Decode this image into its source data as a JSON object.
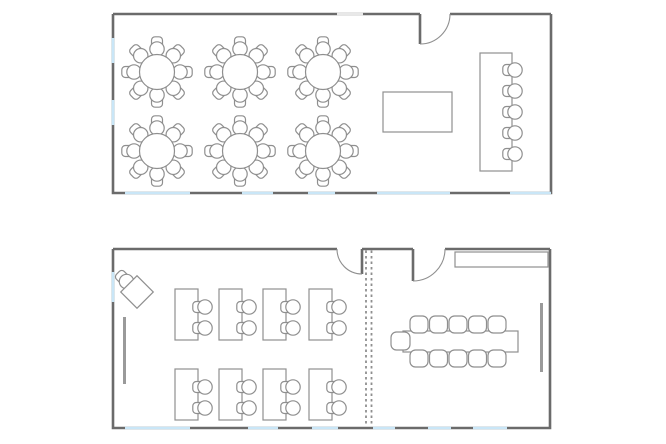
{
  "canvas": {
    "w": 666,
    "h": 444,
    "background": "#ffffff"
  },
  "style": {
    "wall_color": "#6b6b6b",
    "wall_width": 2.6,
    "window_color": "#c9e6f7",
    "opening_color": "#e8e8e8",
    "furn_color": "#8f8f8f",
    "furn_width": 1.2,
    "furn_fill": "#ffffff",
    "seat_r": 7.2,
    "back_size": 11,
    "board_color": "#9a9a9a",
    "board_width": 3,
    "partition_color": "#8f8f8f",
    "partition_width": 1.8,
    "partition_dash": "2.5 3"
  },
  "plans": [
    {
      "id": "top-plan",
      "name": "banquet-room",
      "room": {
        "x": 113,
        "y": 14,
        "w": 438,
        "h": 179
      },
      "top_wall_segments": [
        [
          113,
          420
        ],
        [
          450,
          551
        ]
      ],
      "openings": [
        {
          "side": "top",
          "from": 337,
          "to": 363
        }
      ],
      "doors": [
        {
          "leaf": [
            420,
            14,
            420,
            44
          ],
          "arc": "M 420 44 A 30 30 0 0 0 450 14"
        }
      ],
      "windows": [
        {
          "side": "left",
          "from": 38,
          "to": 63
        },
        {
          "side": "left",
          "from": 100,
          "to": 125
        },
        {
          "side": "bottom",
          "from": 125,
          "to": 190
        },
        {
          "side": "bottom",
          "from": 242,
          "to": 273
        },
        {
          "side": "bottom",
          "from": 308,
          "to": 335
        },
        {
          "side": "bottom",
          "from": 377,
          "to": 450
        },
        {
          "side": "bottom",
          "from": 510,
          "to": 551
        }
      ],
      "round_tables": {
        "radius": 17.5,
        "seat_ring": 23,
        "chairs_per": 8,
        "centers": [
          [
            157,
            72
          ],
          [
            240,
            72
          ],
          [
            323,
            72
          ],
          [
            157,
            151
          ],
          [
            240,
            151
          ],
          [
            323,
            151
          ]
        ]
      },
      "rect_tables": [
        {
          "x": 383,
          "y": 92,
          "w": 69,
          "h": 40
        }
      ],
      "long_tables": [
        {
          "x": 480,
          "y": 53,
          "w": 32,
          "h": 118,
          "chair_cx": 515,
          "chair_cys": [
            70,
            91,
            112,
            133,
            154
          ],
          "chair_angle": 180
        }
      ]
    },
    {
      "id": "bottom-plan",
      "name": "classroom-and-meeting-room",
      "room": {
        "x": 113,
        "y": 249,
        "w": 437,
        "h": 179
      },
      "top_wall_segments": [
        [
          113,
          337
        ],
        [
          362,
          413
        ],
        [
          445,
          550
        ]
      ],
      "doors": [
        {
          "leaf": [
            362,
            249,
            362,
            274
          ],
          "arc": "M 362 274 A 25 25 0 0 1 337 249"
        },
        {
          "leaf": [
            413,
            249,
            413,
            281
          ],
          "arc": "M 413 281 A 32 32 0 0 0 445 249"
        }
      ],
      "partition": {
        "x1": 366,
        "x2": 371.5,
        "y1": 250.5,
        "y2": 426.5
      },
      "windows": [
        {
          "side": "left",
          "from": 272,
          "to": 302
        },
        {
          "side": "bottom",
          "from": 125,
          "to": 190
        },
        {
          "side": "bottom",
          "from": 248,
          "to": 278
        },
        {
          "side": "bottom",
          "from": 312,
          "to": 338
        },
        {
          "side": "bottom",
          "from": 373,
          "to": 395
        },
        {
          "side": "bottom",
          "from": 428,
          "to": 451
        },
        {
          "side": "bottom",
          "from": 473,
          "to": 507
        }
      ],
      "boards": [
        {
          "x": 124.5,
          "y1": 317,
          "y2": 384
        },
        {
          "x": 541.5,
          "y1": 303,
          "y2": 372
        }
      ],
      "teacher_desk": {
        "cx": 137,
        "cy": 292,
        "size": 23,
        "rotation": 45,
        "chair": {
          "cx": 126.5,
          "cy": 281.5,
          "angle": 225
        }
      },
      "desks": {
        "w": 23,
        "h": 51,
        "cols": [
          175,
          219,
          263,
          309
        ],
        "rows": [
          289,
          369
        ],
        "chair_dx": 30,
        "chair_dys": [
          18,
          39
        ],
        "chair_angle": 180
      },
      "conference": {
        "table": {
          "x": 403,
          "y": 331,
          "w": 115,
          "h": 21
        },
        "chair": {
          "w": 18,
          "h": 17,
          "rx": 5.5
        },
        "top_row": {
          "y": 316,
          "xs": [
            419,
            438.5,
            458,
            477.5,
            497
          ]
        },
        "bottom_row": {
          "y": 350,
          "xs": [
            419,
            438.5,
            458,
            477.5,
            497
          ]
        },
        "end_chair": {
          "x": 391,
          "y": 332,
          "w": 19,
          "h": 18
        }
      },
      "cabinet": {
        "x": 455,
        "y": 252,
        "w": 93,
        "h": 15
      }
    }
  ]
}
